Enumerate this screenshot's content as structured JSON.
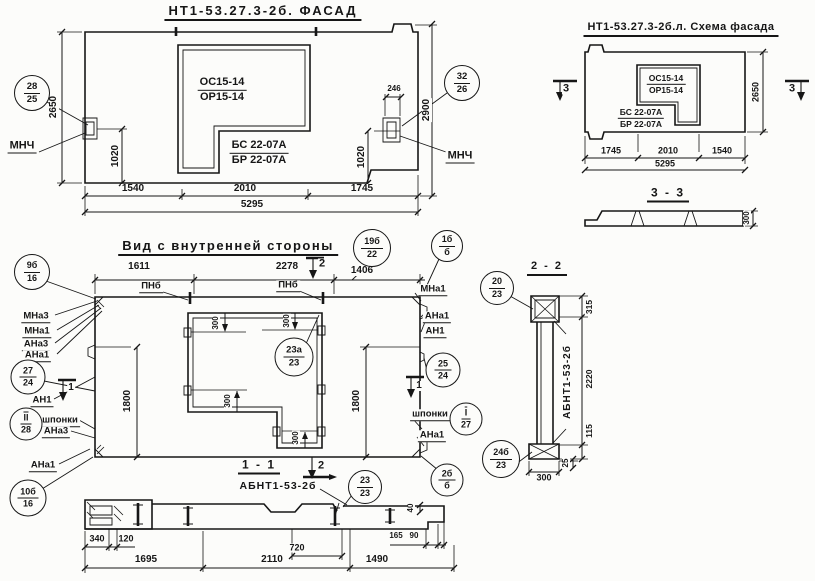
{
  "facade": {
    "title": "НТ1-53.27.3-2б. ФАСАД",
    "opening_mark": {
      "top": "ОС15-14",
      "bottom": "ОР15-14"
    },
    "panel_mark": {
      "top": "БС 22-07А",
      "bottom": "БР 22-07А"
    },
    "mnch_left": "МНЧ",
    "mnch_right": "МНЧ",
    "balloon_left": {
      "top": "28",
      "bottom": "25"
    },
    "balloon_right": {
      "top": "32",
      "bottom": "26"
    },
    "dims": {
      "h_left": "2650",
      "h_right": "2900",
      "hook_left": "1020",
      "hook_right": "1020",
      "notch": "246",
      "bottom": [
        "1540",
        "2010",
        "1745"
      ],
      "total": "5295"
    }
  },
  "schema": {
    "title": "НТ1-53.27.3-2б.л. Схема фасада",
    "opening_mark": {
      "top": "ОС15-14",
      "bottom": "ОР15-14"
    },
    "panel_mark": {
      "top": "БС 22-07А",
      "bottom": "БР 22-07А"
    },
    "marker_left": "3",
    "marker_right": "3",
    "dims": {
      "height": "2650",
      "bottom": [
        "1745",
        "2010",
        "1540"
      ],
      "total": "5295"
    }
  },
  "section33": {
    "title": "3 - 3",
    "dim_thickness": "300"
  },
  "inner": {
    "title": "Вид с внутренней стороны",
    "dims_top": [
      "1611",
      "2278",
      "1406"
    ],
    "marker_top": "2",
    "marker_left": "1",
    "marker_right": "1",
    "pnb_left": "ПНб",
    "pnb_right": "ПНб",
    "left": {
      "mna3": "МНа3",
      "mna1": "МНа1",
      "ana3": "АНа3",
      "ana1": "АНа1",
      "an1": "АН1",
      "shponki": "шпонки",
      "ana3b": "АНа3",
      "ana1b": "АНа1"
    },
    "right": {
      "mna1": "МНа1",
      "ana1": "АНа1",
      "an1": "АН1",
      "shponki": "шпонки",
      "ana1b": "АНа1"
    },
    "dim_h_left": "1800",
    "dim_h_right": "1800",
    "dims300": [
      "300",
      "300",
      "300",
      "300"
    ]
  },
  "balloons": {
    "b9b16": {
      "top": "9б",
      "bottom": "16"
    },
    "b19b22": {
      "top": "19б",
      "bottom": "22"
    },
    "b1bb": {
      "top": "1б",
      "bottom": "б"
    },
    "b2724": {
      "top": "27",
      "bottom": "24"
    },
    "bii28": {
      "top": "II",
      "bottom": "28"
    },
    "b10b16": {
      "top": "10б",
      "bottom": "16"
    },
    "b2524": {
      "top": "25",
      "bottom": "24"
    },
    "bi27": {
      "top": "I",
      "bottom": "27"
    },
    "b2023": {
      "top": "20",
      "bottom": "23"
    },
    "b24b23": {
      "top": "24б",
      "bottom": "23"
    },
    "b23a23": {
      "top": "23а",
      "bottom": "23"
    },
    "b2323": {
      "top": "23",
      "bottom": "23"
    },
    "b2bb": {
      "top": "2б",
      "bottom": "б"
    }
  },
  "section22": {
    "title": "2 - 2",
    "label": "АБНТ1-53-2б",
    "dims": {
      "top": "315",
      "middle": "2220",
      "bottom": "115",
      "foot": "25",
      "width": "300"
    }
  },
  "section11": {
    "title": "1 - 1",
    "label": "АБНТ1-53-2б",
    "marker": "2",
    "dims": {
      "d340": "340",
      "d120": "120",
      "d1695": "1695",
      "d720": "720",
      "d2110": "2110",
      "d1490": "1490",
      "d165": "165",
      "d90": "90",
      "d40": "40"
    }
  }
}
